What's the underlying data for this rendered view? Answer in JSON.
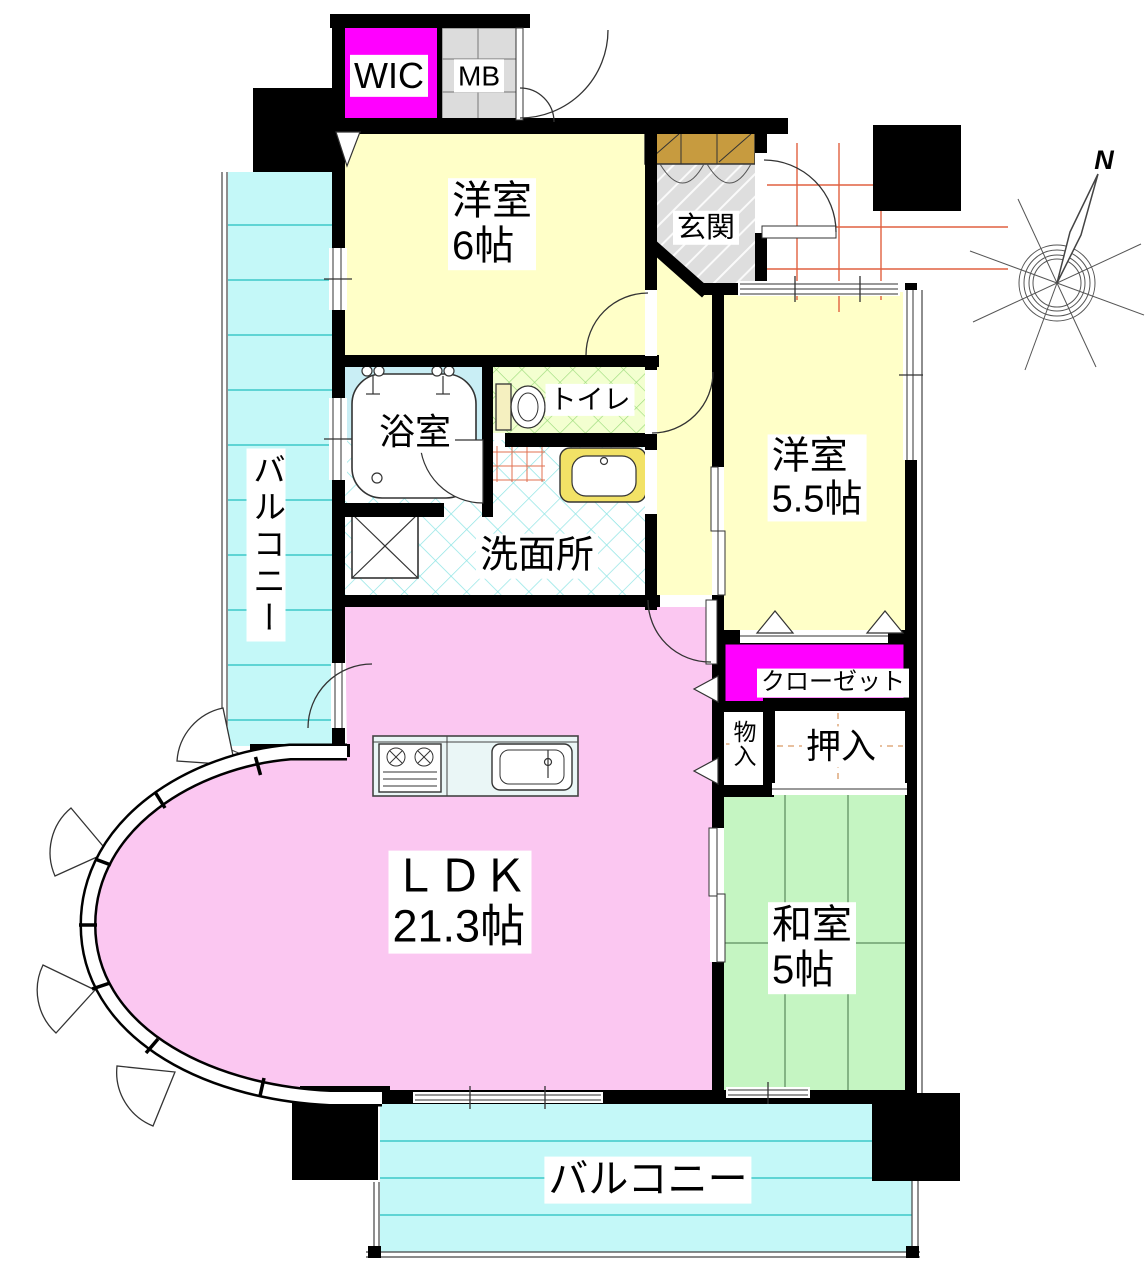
{
  "plan_title": "apartment-floor-plan",
  "labels": {
    "wic": "WIC",
    "mb": "MB",
    "western_room_6": "洋室\n6帖",
    "entrance": "玄関",
    "western_room_5_5": "洋室\n5.5帖",
    "balcony_left": "バルコニー",
    "bathroom": "浴室",
    "toilet": "トイレ",
    "washroom": "洗面所",
    "closet": "クローゼット",
    "storage": "物\n入",
    "oshiire": "押入",
    "ldk": "ＬＤＫ\n21.3帖",
    "japanese_room": "和室\n5帖",
    "balcony_bottom": "バルコニー",
    "compass_north": "N"
  },
  "colors": {
    "wall": "#000000",
    "western_room": "#FFFFC8",
    "ldk_pink": "#FBC7F1",
    "japanese_room_green": "#C5F5C2",
    "balcony_cyan": "#C4F8F8",
    "bathroom_blue": "#C9EEF5",
    "toilet_bg": "#F3FFD0",
    "closet_magenta": "#FF00FF",
    "meter_box_gray": "#DCDCDC",
    "entrance_gray": "#DEDEDE",
    "shoe_cabinet_tan": "#C79B3F",
    "outside_grid_orange": "#E06040",
    "sink_yellow": "#F2E266"
  }
}
